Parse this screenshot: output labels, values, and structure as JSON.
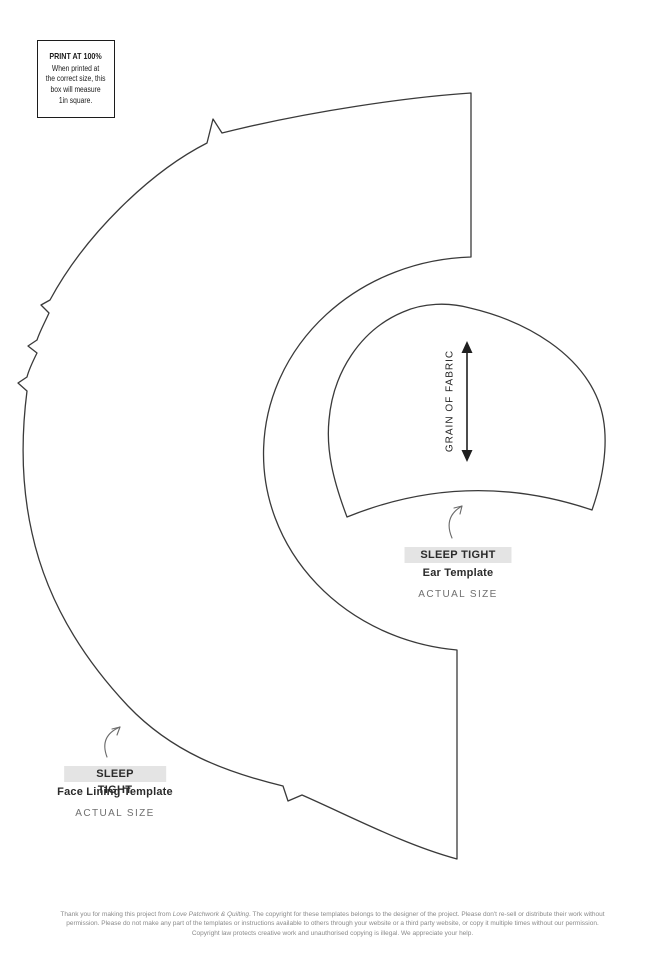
{
  "print_box": {
    "title": "PRINT AT 100%",
    "lines": [
      "When printed at",
      "the correct size, this",
      "box will measure",
      "1in square."
    ]
  },
  "ear_template": {
    "badge": "SLEEP TIGHT",
    "name": "Ear Template",
    "size_note": "ACTUAL SIZE",
    "grain_label": "GRAIN OF FABRIC"
  },
  "face_template": {
    "badge": "SLEEP TIGHT",
    "name": "Face Lining Template",
    "size_note": "ACTUAL SIZE"
  },
  "footer": {
    "part1": "Thank you for making this project from ",
    "magazine": "Love Patchwork & Quilting",
    "part2": ". The copyright for these templates belongs to the designer of the project. Please don't re-sell or distribute their work without permission. Please do not make any part of the templates or instructions available to others through your website or a third party website, or copy it multiple times without our permission. Copyright law protects creative work and unauthorised copying is illegal. We appreciate your help."
  },
  "colors": {
    "outline": "#3a3a3a",
    "badge_bg": "#e4e4e4",
    "muted_text": "#6f6f6f",
    "footer_text": "#8a8a8a"
  }
}
